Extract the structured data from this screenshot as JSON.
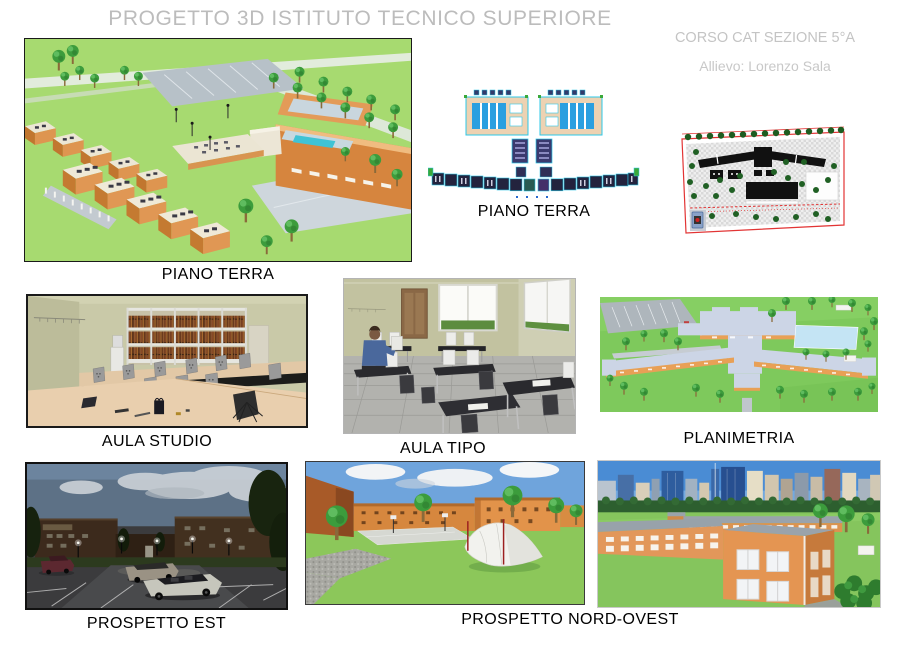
{
  "header": {
    "title": "PROGETTO 3D ISTITUTO TECNICO SUPERIORE",
    "course": "CORSO CAT SEZIONE 5°A",
    "student": "Allievo: Lorenzo Sala"
  },
  "figures": {
    "piano_terra_3d": {
      "caption": "PIANO TERRA",
      "description": "3D aerial render of ground floor with open-roof classrooms, trees and sports court"
    },
    "piano_terra_cad": {
      "caption": "PIANO TERRA",
      "description": "CAD colour floor plan with twin gym halls and angled classroom wings"
    },
    "site_plan": {
      "description": "Site plan with red boundary, hatched ground, black building footprints and trees"
    },
    "aula_studio": {
      "caption": "AULA STUDIO",
      "description": "Study room render with bookshelves, tan tables and grey chairs"
    },
    "aula_tipo": {
      "caption": "AULA TIPO",
      "description": "Computer classroom render with desks, monitors and seated figure"
    },
    "planimetria": {
      "caption": "PLANIMETRIA",
      "description": "Aerial site render with roofs, parking lot and light-blue court"
    },
    "prospetto_est": {
      "caption": "PROSPETTO EST",
      "description": "Night view of east elevation with parking lot, cars and street lamps"
    },
    "prospetto_nord_ovest": {
      "caption": "PROSPETTO NORD-OVEST",
      "description": "Day views of north-west elevation: courtyard with tent structure and orange school building against city skyline"
    }
  },
  "colors": {
    "title_gray": "#bcbcbc",
    "caption_black": "#000000",
    "grass_green": "#a7da70",
    "building_orange": "#e0985a",
    "cad_cyan": "#2cc8e8",
    "cad_blue": "#2a9fe0",
    "site_plan_red": "#e23434",
    "sky_blue": "#6fa4dc",
    "night_sky": "#5d7186"
  }
}
